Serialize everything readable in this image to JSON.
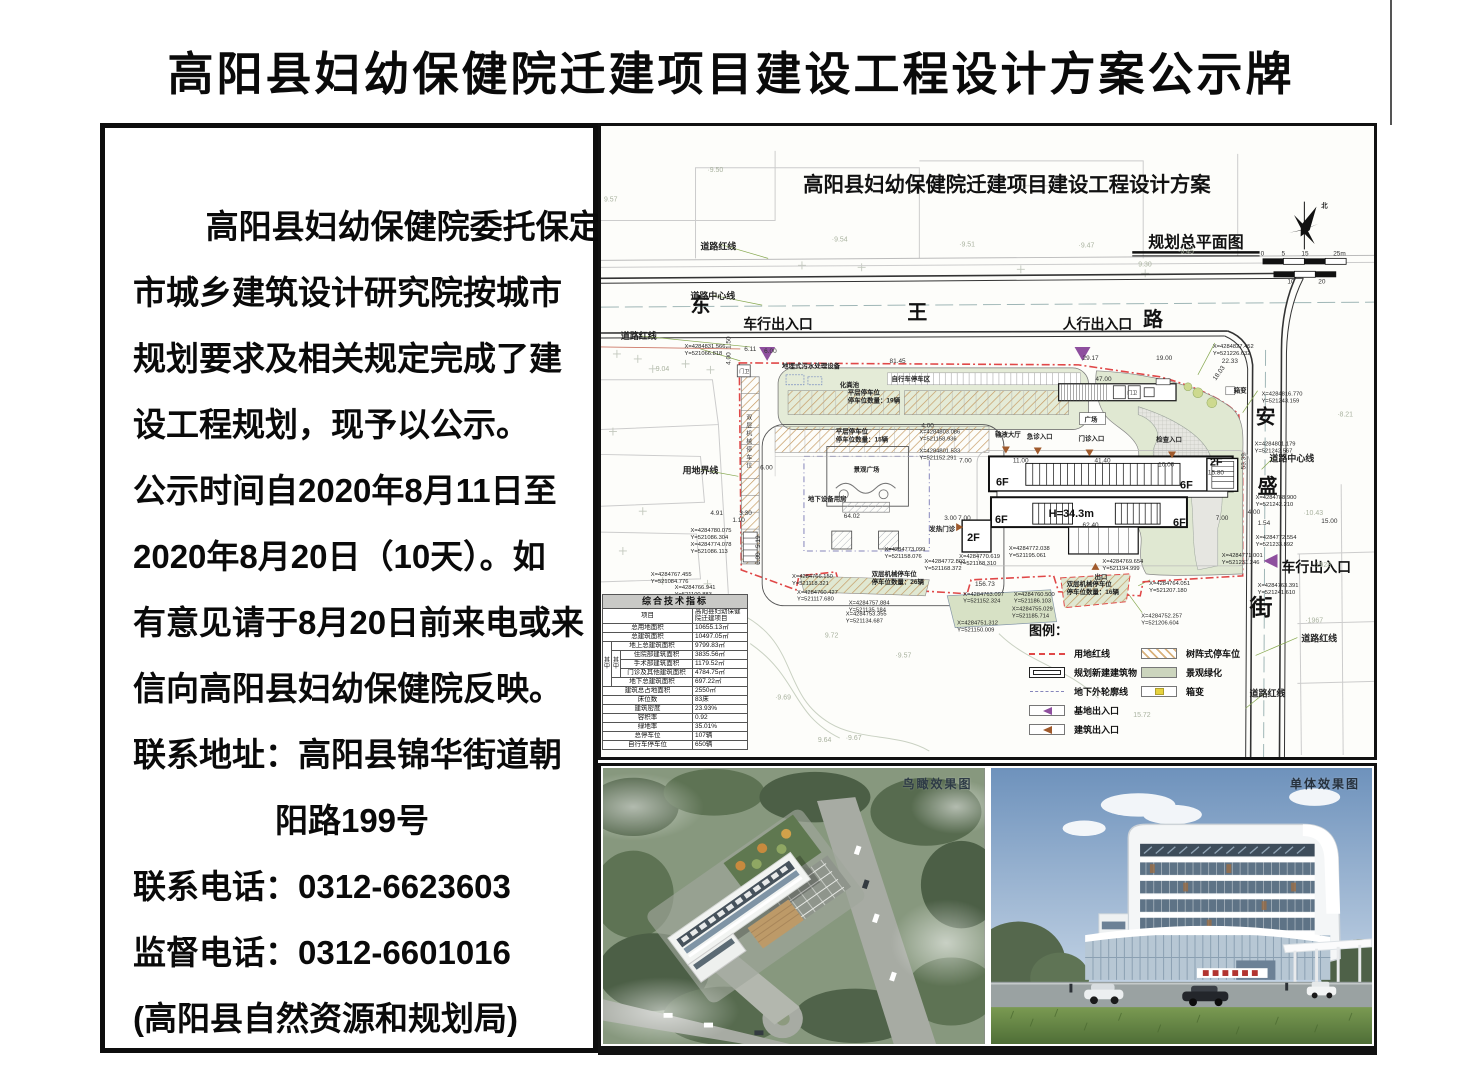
{
  "page_title": "高阳县妇幼保健院迁建项目建设工程设计方案公示牌",
  "notice": {
    "lines": [
      "高阳县妇幼保健院委托保定",
      "市城乡建筑设计研究院按城市",
      "规划要求及相关规定完成了建",
      "设工程规划，现予以公示。",
      "公示时间自2020年8月11日至",
      "2020年8月20日（10天）。如",
      "有意见请于8月20日前来电或来",
      "信向高阳县妇幼保健院反映。",
      "联系地址：高阳县锦华街道朝",
      "阳路199号",
      "联系电话：0312-6623603",
      "监督电话：0312-6601016",
      "(高阳县自然资源和规划局)"
    ]
  },
  "plan": {
    "title": "高阳县妇幼保健院迁建项目建设工程设计方案",
    "subtitle": "规划总平面图",
    "labels": [
      {
        "t": "东",
        "x": 90,
        "y": 187,
        "c": "roadname",
        "n": "road-name-dong"
      },
      {
        "t": "王",
        "x": 308,
        "y": 194,
        "c": "roadname",
        "n": "road-name-wang"
      },
      {
        "t": "路",
        "x": 545,
        "y": 201,
        "c": "roadname",
        "n": "road-name-lu"
      },
      {
        "t": "安",
        "x": 658,
        "y": 299,
        "c": "roadname",
        "n": "road-name-an"
      },
      {
        "t": "盛",
        "x": 660,
        "y": 369,
        "c": "roadname",
        "n": "road-name-sheng"
      },
      {
        "t": "街",
        "x": 652,
        "y": 492,
        "c": "roadname2",
        "n": "road-name-jie"
      },
      {
        "t": "北",
        "x": 724,
        "y": 82,
        "c": "feat",
        "n": "north-label"
      },
      {
        "t": "道路红线",
        "x": 100,
        "y": 124,
        "c": "lbl"
      },
      {
        "t": "道路中心线",
        "x": 90,
        "y": 174,
        "c": "lbl"
      },
      {
        "t": "道路红线",
        "x": 20,
        "y": 214,
        "c": "lbl"
      },
      {
        "t": "用地界线",
        "x": 82,
        "y": 349,
        "c": "lbl"
      },
      {
        "t": "道路中心线",
        "x": 672,
        "y": 337,
        "c": "lbl"
      },
      {
        "t": "道路红线",
        "x": 704,
        "y": 518,
        "c": "lbl"
      },
      {
        "t": "道路红线",
        "x": 652,
        "y": 573,
        "c": "lbl"
      },
      {
        "t": "车行出入口",
        "x": 143,
        "y": 204,
        "c": "entry",
        "n": "vehicle-entrance-label"
      },
      {
        "t": "人行出入口",
        "x": 464,
        "y": 204,
        "c": "entry",
        "n": "pedestrian-entrance-label"
      },
      {
        "t": "车行出入口",
        "x": 684,
        "y": 448,
        "c": "entry",
        "n": "vehicle-entrance-east-label"
      },
      {
        "t": "地埋式污水处理设备",
        "x": 182,
        "y": 243,
        "c": "feat"
      },
      {
        "t": "自行车停车区",
        "x": 292,
        "y": 256,
        "c": "feat"
      },
      {
        "t": "化粪池",
        "x": 240,
        "y": 262,
        "c": "feat"
      },
      {
        "t": "平层停车位",
        "x": 248,
        "y": 270,
        "c": "feat"
      },
      {
        "t": "停车位数量：19辆",
        "x": 248,
        "y": 278,
        "c": "feat"
      },
      {
        "t": "平层停车位",
        "x": 236,
        "y": 309,
        "c": "feat"
      },
      {
        "t": "停车位数量：15辆",
        "x": 236,
        "y": 317,
        "c": "feat"
      },
      {
        "t": "景观广场",
        "x": 254,
        "y": 347,
        "c": "feat"
      },
      {
        "t": "地下设备用房",
        "x": 208,
        "y": 377,
        "c": "feat"
      },
      {
        "t": "双层机械停车位",
        "x": 272,
        "y": 452,
        "c": "feat"
      },
      {
        "t": "停车位数量：26辆",
        "x": 272,
        "y": 460,
        "c": "feat"
      },
      {
        "t": "双层机械停车位",
        "x": 468,
        "y": 462,
        "c": "feat"
      },
      {
        "t": "停车位数量：16辆",
        "x": 468,
        "y": 470,
        "c": "feat"
      },
      {
        "t": "广场",
        "x": 486,
        "y": 297,
        "c": "feat"
      },
      {
        "t": "门卫",
        "x": 139,
        "y": 248,
        "c": "tiny"
      },
      {
        "t": "门卫",
        "x": 529,
        "y": 270,
        "c": "tiny"
      },
      {
        "t": "箱变",
        "x": 636,
        "y": 268,
        "c": "feat"
      },
      {
        "t": "发热门诊",
        "x": 330,
        "y": 407,
        "c": "feat"
      },
      {
        "t": "出口",
        "x": 496,
        "y": 455,
        "c": "feat"
      },
      {
        "t": "输液大厅",
        "x": 396,
        "y": 312,
        "c": "feat"
      },
      {
        "t": "急诊入口",
        "x": 428,
        "y": 314,
        "c": "feat"
      },
      {
        "t": "门诊入口",
        "x": 480,
        "y": 316,
        "c": "feat"
      },
      {
        "t": "检查入口",
        "x": 558,
        "y": 317,
        "c": "feat"
      },
      {
        "t": "6F",
        "x": 397,
        "y": 361,
        "c": "bld"
      },
      {
        "t": "6F",
        "x": 582,
        "y": 364,
        "c": "bld"
      },
      {
        "t": "6F",
        "x": 396,
        "y": 399,
        "c": "bld"
      },
      {
        "t": "6F",
        "x": 575,
        "y": 402,
        "c": "bld"
      },
      {
        "t": "2F",
        "x": 612,
        "y": 341,
        "c": "bld"
      },
      {
        "t": "2F",
        "x": 368,
        "y": 417,
        "c": "bld"
      },
      {
        "t": "H=34.3m",
        "x": 450,
        "y": 393,
        "c": "bldh"
      },
      {
        "t": "15.80",
        "x": 610,
        "y": 350,
        "c": "dim"
      },
      {
        "t": "6.11",
        "x": 144,
        "y": 226,
        "c": "dim"
      },
      {
        "t": "6.00",
        "x": 164,
        "y": 228,
        "c": "dim"
      },
      {
        "t": "81.45",
        "x": 290,
        "y": 238,
        "c": "dim"
      },
      {
        "t": "29.17",
        "x": 484,
        "y": 235,
        "c": "dim"
      },
      {
        "t": "47.00",
        "x": 497,
        "y": 256,
        "c": "dim"
      },
      {
        "t": "19.00",
        "x": 558,
        "y": 235,
        "c": "dim"
      },
      {
        "t": "22.33",
        "x": 624,
        "y": 238,
        "c": "dim"
      },
      {
        "t": "18.03",
        "x": 618,
        "y": 256,
        "c": "dim",
        "r": -55
      },
      {
        "t": "41.40",
        "x": 496,
        "y": 338,
        "c": "dim"
      },
      {
        "t": "10.00",
        "x": 560,
        "y": 342,
        "c": "dim"
      },
      {
        "t": "11.00",
        "x": 414,
        "y": 338,
        "c": "dim"
      },
      {
        "t": "7.00",
        "x": 360,
        "y": 338,
        "c": "dim"
      },
      {
        "t": "7.00",
        "x": 359,
        "y": 396,
        "c": "dim"
      },
      {
        "t": "3.00",
        "x": 345,
        "y": 396,
        "c": "dim"
      },
      {
        "t": "7.00",
        "x": 618,
        "y": 396,
        "c": "dim"
      },
      {
        "t": "4.00",
        "x": 650,
        "y": 390,
        "c": "dim"
      },
      {
        "t": "1.54",
        "x": 660,
        "y": 401,
        "c": "dim"
      },
      {
        "t": "15.00",
        "x": 724,
        "y": 399,
        "c": "dim"
      },
      {
        "t": "62.40",
        "x": 484,
        "y": 403,
        "c": "dim"
      },
      {
        "t": "64.02",
        "x": 244,
        "y": 394,
        "c": "dim"
      },
      {
        "t": "156.73",
        "x": 376,
        "y": 462,
        "c": "dim"
      },
      {
        "t": "6.00",
        "x": 160,
        "y": 345,
        "c": "dim"
      },
      {
        "t": "4.91",
        "x": 110,
        "y": 391,
        "c": "dim"
      },
      {
        "t": "3.30",
        "x": 139,
        "y": 391,
        "c": "dim"
      },
      {
        "t": "1.10",
        "x": 132,
        "y": 398,
        "c": "dim"
      },
      {
        "t": "4.00",
        "x": 322,
        "y": 303,
        "c": "dim"
      },
      {
        "t": "5.19",
        "x": 160,
        "y": 424,
        "c": "dim",
        "r": -90
      },
      {
        "t": "6.00",
        "x": 160,
        "y": 441,
        "c": "dim",
        "r": -90
      },
      {
        "t": "53.39",
        "x": 648,
        "y": 345,
        "c": "dim",
        "r": -90
      },
      {
        "t": "1.50",
        "x": 130,
        "y": 224,
        "c": "dim",
        "r": -90
      },
      {
        "t": "4.00",
        "x": 130,
        "y": 240,
        "c": "dim",
        "r": -90
      },
      {
        "t": "0",
        "x": 663,
        "y": 130,
        "c": "dim"
      },
      {
        "t": "5",
        "x": 684,
        "y": 130,
        "c": "dim"
      },
      {
        "t": "15",
        "x": 704,
        "y": 130,
        "c": "dim"
      },
      {
        "t": "25m",
        "x": 736,
        "y": 130,
        "c": "dim"
      },
      {
        "t": "10",
        "x": 690,
        "y": 158,
        "c": "dim"
      },
      {
        "t": "20",
        "x": 721,
        "y": 158,
        "c": "dim"
      },
      {
        "t": "X=4284831.566",
        "x": 84,
        "y": 223,
        "c": "coord"
      },
      {
        "t": "Y=521066.818",
        "x": 84,
        "y": 230,
        "c": "coord"
      },
      {
        "t": "X=4284827.452",
        "x": 615,
        "y": 223,
        "c": "coord"
      },
      {
        "t": "Y=521226.632",
        "x": 615,
        "y": 230,
        "c": "coord"
      },
      {
        "t": "X=4284816.770",
        "x": 664,
        "y": 271,
        "c": "coord"
      },
      {
        "t": "Y=521243.159",
        "x": 664,
        "y": 278,
        "c": "coord"
      },
      {
        "t": "X=4284801.179",
        "x": 657,
        "y": 321,
        "c": "coord"
      },
      {
        "t": "Y=521242.567",
        "x": 657,
        "y": 328,
        "c": "coord"
      },
      {
        "t": "X=4284788.900",
        "x": 658,
        "y": 375,
        "c": "coord"
      },
      {
        "t": "Y=521242.210",
        "x": 658,
        "y": 382,
        "c": "coord"
      },
      {
        "t": "X=4284772.554",
        "x": 658,
        "y": 415,
        "c": "coord"
      },
      {
        "t": "Y=521233.892",
        "x": 658,
        "y": 422,
        "c": "coord"
      },
      {
        "t": "X=4284771.001",
        "x": 624,
        "y": 433,
        "c": "coord"
      },
      {
        "t": "Y=521231.246",
        "x": 624,
        "y": 440,
        "c": "coord"
      },
      {
        "t": "X=4284763.391",
        "x": 660,
        "y": 463,
        "c": "coord"
      },
      {
        "t": "Y=521241.610",
        "x": 660,
        "y": 470,
        "c": "coord"
      },
      {
        "t": "X=4284803.086",
        "x": 320,
        "y": 309,
        "c": "coord"
      },
      {
        "t": "Y=521158.936",
        "x": 320,
        "y": 316,
        "c": "coord"
      },
      {
        "t": "X=4284801.533",
        "x": 320,
        "y": 328,
        "c": "coord"
      },
      {
        "t": "Y=521152.291",
        "x": 320,
        "y": 335,
        "c": "coord"
      },
      {
        "t": "X=4284780.075",
        "x": 90,
        "y": 408,
        "c": "coord"
      },
      {
        "t": "Y=521086.304",
        "x": 90,
        "y": 415,
        "c": "coord"
      },
      {
        "t": "X=4284774.078",
        "x": 90,
        "y": 422,
        "c": "coord"
      },
      {
        "t": "Y=521086.113",
        "x": 90,
        "y": 429,
        "c": "coord"
      },
      {
        "t": "X=4284767.455",
        "x": 50,
        "y": 452,
        "c": "coord"
      },
      {
        "t": "Y=521084.776",
        "x": 50,
        "y": 459,
        "c": "coord"
      },
      {
        "t": "X=4284766.941",
        "x": 74,
        "y": 465,
        "c": "coord"
      },
      {
        "t": "Y=521100.883",
        "x": 74,
        "y": 472,
        "c": "coord"
      },
      {
        "t": "X=4284766.150",
        "x": 192,
        "y": 454,
        "c": "coord"
      },
      {
        "t": "Y=521118.321",
        "x": 192,
        "y": 461,
        "c": "coord"
      },
      {
        "t": "X=4284760.427",
        "x": 197,
        "y": 470,
        "c": "coord"
      },
      {
        "t": "Y=521117.680",
        "x": 197,
        "y": 477,
        "c": "coord"
      },
      {
        "t": "X=4284757.884",
        "x": 249,
        "y": 481,
        "c": "coord"
      },
      {
        "t": "Y=521135.184",
        "x": 249,
        "y": 488,
        "c": "coord"
      },
      {
        "t": "X=4284753.355",
        "x": 246,
        "y": 492,
        "c": "coord"
      },
      {
        "t": "Y=521134.687",
        "x": 246,
        "y": 499,
        "c": "coord"
      },
      {
        "t": "X=4284751.312",
        "x": 358,
        "y": 501,
        "c": "coord"
      },
      {
        "t": "Y=521150.009",
        "x": 358,
        "y": 508,
        "c": "coord"
      },
      {
        "t": "X=4284763.097",
        "x": 364,
        "y": 472,
        "c": "coord"
      },
      {
        "t": "Y=521152.324",
        "x": 364,
        "y": 479,
        "c": "coord"
      },
      {
        "t": "X=4284760.500",
        "x": 415,
        "y": 472,
        "c": "coord"
      },
      {
        "t": "Y=521186.103",
        "x": 415,
        "y": 479,
        "c": "coord"
      },
      {
        "t": "X=4284755.029",
        "x": 413,
        "y": 487,
        "c": "coord"
      },
      {
        "t": "Y=521185.714",
        "x": 413,
        "y": 494,
        "c": "coord"
      },
      {
        "t": "X=4284764.051",
        "x": 551,
        "y": 461,
        "c": "coord"
      },
      {
        "t": "Y=521207.180",
        "x": 551,
        "y": 468,
        "c": "coord"
      },
      {
        "t": "X=4284752.257",
        "x": 543,
        "y": 494,
        "c": "coord"
      },
      {
        "t": "Y=521206.604",
        "x": 543,
        "y": 501,
        "c": "coord"
      },
      {
        "t": "X=4284772.038",
        "x": 410,
        "y": 426,
        "c": "coord"
      },
      {
        "t": "Y=521195.061",
        "x": 410,
        "y": 433,
        "c": "coord"
      },
      {
        "t": "X=4284769.654",
        "x": 504,
        "y": 439,
        "c": "coord"
      },
      {
        "t": "Y=521194.999",
        "x": 504,
        "y": 446,
        "c": "coord"
      },
      {
        "t": "X=4284770.619",
        "x": 360,
        "y": 434,
        "c": "coord"
      },
      {
        "t": "Y=521168.310",
        "x": 360,
        "y": 441,
        "c": "coord"
      },
      {
        "t": "X=4284772.803",
        "x": 325,
        "y": 439,
        "c": "coord"
      },
      {
        "t": "Y=521168.372",
        "x": 325,
        "y": 446,
        "c": "coord"
      },
      {
        "t": "X=4284773.099",
        "x": 285,
        "y": 427,
        "c": "coord"
      },
      {
        "t": "Y=521158.076",
        "x": 285,
        "y": 434,
        "c": "coord"
      },
      {
        "t": "·9.50",
        "x": 107,
        "y": 46,
        "c": "elev"
      },
      {
        "t": "9.57",
        "x": 3,
        "y": 76,
        "c": "elev"
      },
      {
        "t": "·9.54",
        "x": 232,
        "y": 116,
        "c": "elev"
      },
      {
        "t": "·9.51",
        "x": 360,
        "y": 121,
        "c": "elev"
      },
      {
        "t": "·9.47",
        "x": 480,
        "y": 122,
        "c": "elev"
      },
      {
        "t": "·9.45",
        "x": 580,
        "y": 128,
        "c": "elev"
      },
      {
        "t": "9.30",
        "x": 540,
        "y": 141,
        "c": "elev"
      },
      {
        "t": "9.04",
        "x": 55,
        "y": 246,
        "c": "elev"
      },
      {
        "t": "·8.21",
        "x": 740,
        "y": 292,
        "c": "elev"
      },
      {
        "t": "·10.43",
        "x": 706,
        "y": 391,
        "c": "elev"
      },
      {
        "t": "·1928",
        "x": 716,
        "y": 443,
        "c": "elev"
      },
      {
        "t": "·1967",
        "x": 708,
        "y": 499,
        "c": "elev"
      },
      {
        "t": "9.72",
        "x": 225,
        "y": 514,
        "c": "elev"
      },
      {
        "t": "·9.57",
        "x": 296,
        "y": 534,
        "c": "elev"
      },
      {
        "t": "·9.69",
        "x": 175,
        "y": 576,
        "c": "elev"
      },
      {
        "t": "9.64",
        "x": 218,
        "y": 619,
        "c": "elev"
      },
      {
        "t": "·9.67",
        "x": 246,
        "y": 617,
        "c": "elev"
      },
      {
        "t": "15.72",
        "x": 535,
        "y": 594,
        "c": "elev"
      },
      {
        "t": "双",
        "x": 146,
        "y": 295,
        "c": "tiny6"
      },
      {
        "t": "层",
        "x": 146,
        "y": 303,
        "c": "tiny6"
      },
      {
        "t": "机",
        "x": 146,
        "y": 311,
        "c": "tiny6"
      },
      {
        "t": "械",
        "x": 146,
        "y": 319,
        "c": "tiny6"
      },
      {
        "t": "停",
        "x": 146,
        "y": 327,
        "c": "tiny6"
      },
      {
        "t": "车",
        "x": 146,
        "y": 335,
        "c": "tiny6"
      },
      {
        "t": "位",
        "x": 146,
        "y": 343,
        "c": "tiny6"
      }
    ]
  },
  "table": {
    "title": "综合技术指标",
    "group_outer": "其中",
    "group_inner": "其中",
    "rows": [
      [
        "项目",
        "高阳县妇幼保健院迁建项目"
      ],
      [
        "总用地面积",
        "10655.13㎡"
      ],
      [
        "总建筑面积",
        "10497.05㎡"
      ],
      [
        "地上总建筑面积",
        "9799.83㎡"
      ],
      [
        "住院部建筑面积",
        "3835.56㎡"
      ],
      [
        "手术部建筑面积",
        "1179.52㎡"
      ],
      [
        "门诊及其他建筑面积",
        "4784.75㎡"
      ],
      [
        "地下总建筑面积",
        "697.22㎡"
      ],
      [
        "建筑总占地面积",
        "2550㎡"
      ],
      [
        "床位数",
        "83床"
      ],
      [
        "建筑密度",
        "23.93%"
      ],
      [
        "容积率",
        "0.92"
      ],
      [
        "绿地率",
        "35.01%"
      ],
      [
        "总停车位",
        "107辆"
      ],
      [
        "自行车停车位",
        "650辆"
      ]
    ]
  },
  "legend": {
    "title": "图例：",
    "left": [
      {
        "name": "用地红线"
      },
      {
        "name": "规划新建建筑物"
      },
      {
        "name": "地下外轮廓线"
      },
      {
        "name": "基地出入口"
      },
      {
        "name": "建筑出入口"
      }
    ],
    "right": [
      {
        "name": "树阵式停车位"
      },
      {
        "name": "景观绿化"
      },
      {
        "name": "箱变"
      }
    ]
  },
  "renders": [
    {
      "label": "鸟瞰效果图"
    },
    {
      "label": "单体效果图"
    }
  ],
  "colors": {
    "boundary_red": "#e04848",
    "site_entry_purple": "#8e4f9e",
    "building_entry_brown": "#a05a2c",
    "greenery": "#e0e8d2",
    "underground_blue": "#8585bb"
  }
}
